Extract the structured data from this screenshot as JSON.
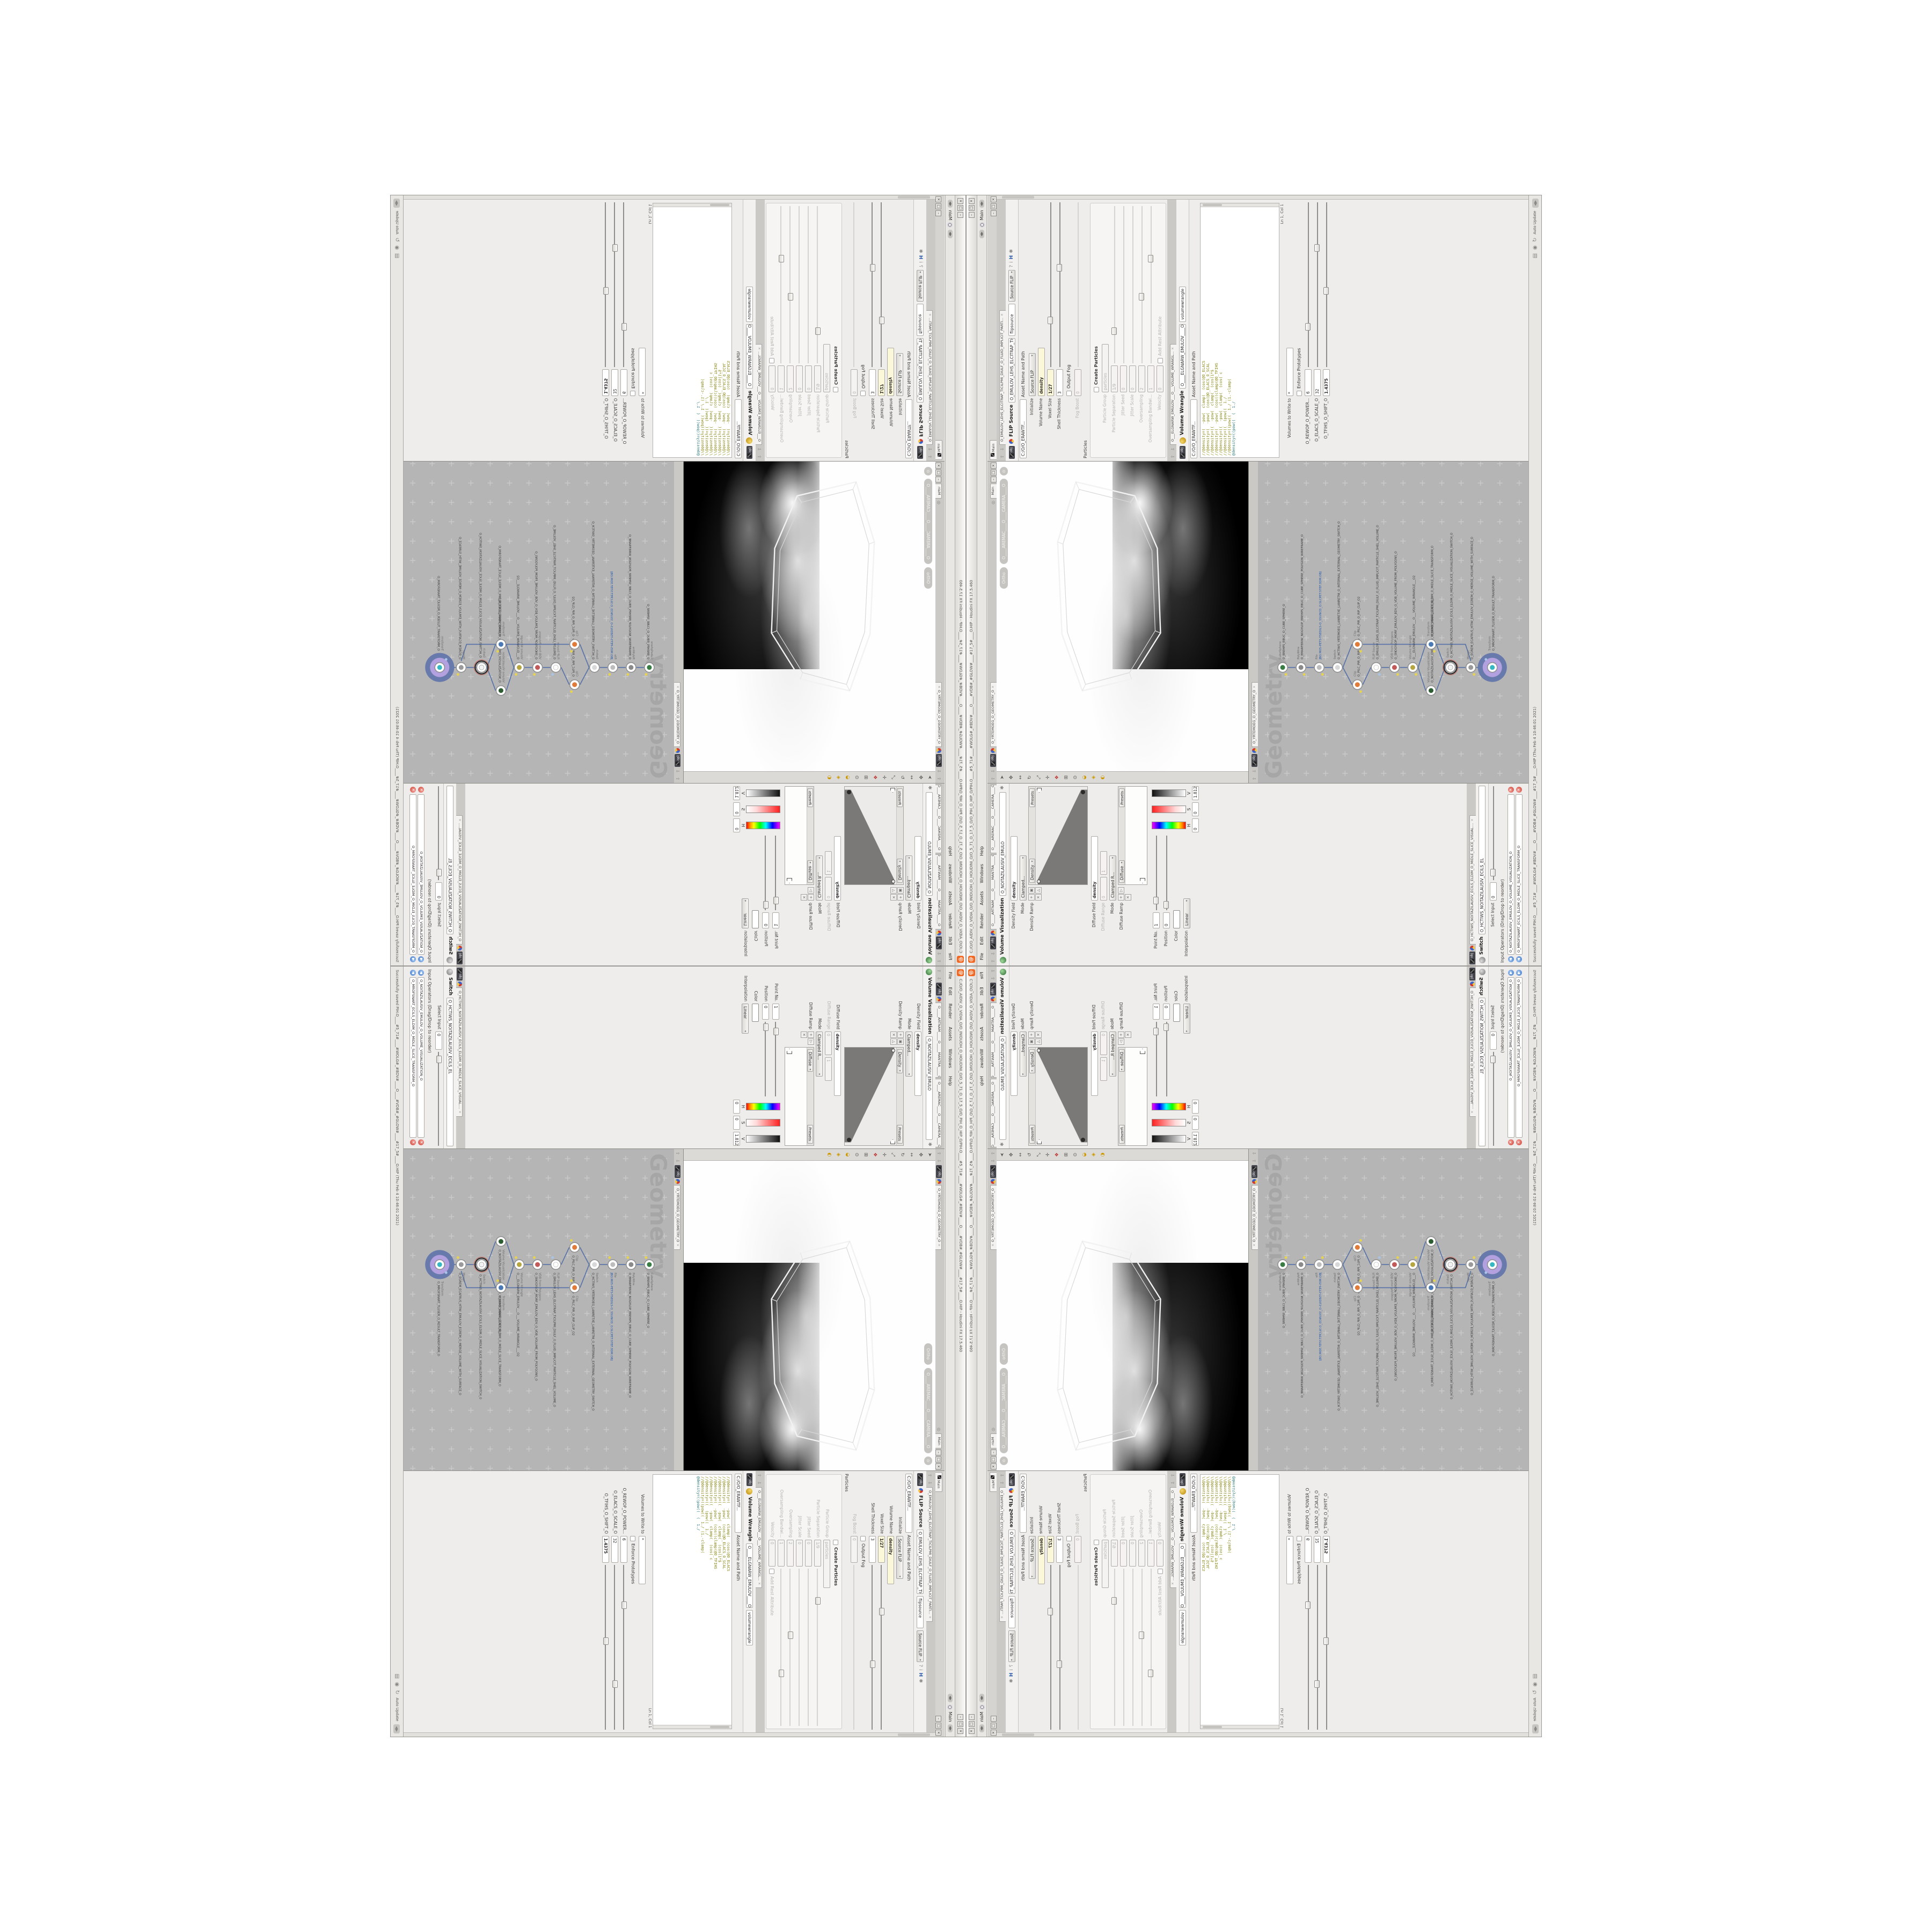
{
  "app": {
    "logo_color": "#f26722",
    "title": "C:/O/O_AIDIV_O_VIDIA_O/O_INIDUOH_O_HOUDINI_O/O_5_71_O_17_5_O/O_PIH_O_HIP_O/PIH.O____#5_71#____#WOLG#_#BDV#____O____#VDB#_#GLOW#____#17_5#____O.HIP - Houdini FX 17.5.460",
    "menus": [
      "File",
      "Edit",
      "Render",
      "Assets",
      "Windows",
      "Help"
    ],
    "desktop_label": "Main",
    "btn_min": "–",
    "btn_max": "□",
    "btn_close": "×"
  },
  "panelbar": {
    "main_tab": "Main"
  },
  "viz": {
    "tab_mantra": "O_____ARTNAM_____O_____MANTRA_____O",
    "tab_camera": "O____AREMAC____O____CAMERA____O",
    "title": "Volume Visualization",
    "name_field": "O_NOITAZILAUSIV_EMULO",
    "density_field_label": "Density Field",
    "density_field_value": "density",
    "mode_label": "Mode",
    "mode_value": "Clamped...",
    "density_ramp_label": "Density Ramp",
    "ramp_selector": "Density",
    "presets_label": "Presets",
    "diffuse_field_label": "Diffuse Field",
    "diffuse_field_value": "density",
    "diffuse_range_label": "Diffuse Range",
    "diffuse_range_v1": "0",
    "diffuse_range_v2": "1",
    "mode2_label": "Mode",
    "mode2_value": "Clamped R...",
    "diffuse_ramp_label": "Diffuse Ramp",
    "ramp_selector2": "Diffuse",
    "point_label": "Point No.",
    "point_value": "1",
    "position_label": "Position",
    "position_value": "0",
    "color_label": "Color",
    "interp_label": "Interpolation",
    "interp_value": "Linear",
    "h_label": "H",
    "h_value": "0",
    "s_label": "S",
    "s_value": "0",
    "v_label": "V",
    "v_value": "1.8125"
  },
  "switch_pane": {
    "tab": "O_HCTIWS_NOITAZILAUSIV_ECILS_ELDIM_O_MIDLE_SLICE_VISUAL....",
    "title": "Switch",
    "name_field": "O_HCTIWS_NOITAZILAUSIV_ECILS_EL",
    "select_label": "Select Input",
    "select_value": "0",
    "ops_label": "Input Operators (Drag/Drop to reorder)",
    "op1": "O_NOITAZILAUSIV_EMULOV_O_VOLUME_VISUALIZATION_O",
    "op2": "O_MROFSNART_ECILS_ELDIM_O_MIDLE_SLICE_TRANSFORM_O"
  },
  "viewport": {
    "tab": "O_YRTEMOEG_O_GEOMETRY_O",
    "ortho_label": "Ortho",
    "camera_pill": "O____AREMAC____O____CAMERA____O"
  },
  "network": {
    "tab": "O_YRTEMOEG_O_GEOMETRY_O",
    "watermark": "Geometry",
    "wire_color": "#5570a8",
    "bg_color": "#b5b5b5",
    "badge_outer": "#6879ab",
    "badge_inner": "#b2a0df",
    "flag_color": "#e8d44d",
    "nodes": [
      {
        "t": "CubeSphere",
        "n": "O_EREHPS_EBUC_O_CUBE_SPHERE_O",
        "c": "#3a7d44"
      },
      {
        "t": "PolyWire",
        "n": "O_EMARFERIW_NOGYLOP_EREHPS_EBUC_O_CUBE_SPHERE_POLYGON_WIREFRAME_O",
        "c": "#8a8a8a"
      },
      {
        "t": "File",
        "n": "JBO.M05-PETS-TSEDILS-O_SSUNCD_O.SLCPET.STEF.3DM.OBJ",
        "c": "#bdbdbd"
      },
      {
        "t": "Switch",
        "n": "O_HCTIWS_YRTEMOEG_LANRETXE_LANRETNI_O_INTERNAL_EXTERNAL_GEOMETRY_SWITCH_O",
        "c": "#d8d8d8"
      },
      {
        "t": "Clip",
        "n": "O_PILC_PIR_O_RIP_CLIP_O",
        "c": "#e07b39"
      },
      {
        "t": "Clip",
        "n": "O_PILC_PIR_O_RIP_CLIP_O2",
        "c": "#e07b39"
      },
      {
        "t": "FLIP Source",
        "n": "O_EMULOV_LEHS_ELCITRAP_TICILPMI_DIULF_O_FLUID_IMPLICIT_PARTICLE_SHEL_VOLUME_O",
        "c": "#ffffff"
      },
      {
        "t": "VDB from Polygons",
        "n": "O_SNOGYLOP_MORF_EMULOV_BDV_O_VDB_VOLUME_FROM_POLYGONS_O",
        "c": "#c25a5a"
      },
      {
        "t": "Volume Wrangle",
        "n": "O___ELGNARW_EMULOV___O___VOLUME_WRANGLE___O2",
        "c": "#b5a642"
      },
      {
        "t": "Volume Visualization",
        "n": "O_NOITAZILAUSIV_EMULOV_O_VOLUME_VISUALIZATION_O",
        "c": "#2e5d34"
      },
      {
        "t": "Transform",
        "n": "O_MROFSNART_ECILS_ELDIM_O_MIDLE_SLICE_TRANSFORM_O",
        "c": "#4a7ab5"
      },
      {
        "t": "Switch",
        "n": "O_HCTIWS_NOITAZILAUSIV_ECILS_ELDIM_O_MIDLE_SLICE_VISUALIZATION_SWITCH_O",
        "c": "#f2f2f2"
      },
      {
        "t": "Merge",
        "n": "O_EGREM_ECAFRUS_HTIW_EMULOV_EGREM_O_MERGE_VOLUME_WITH_SURFACE_O",
        "c": "#9a9a9a"
      },
      {
        "t": "Transform",
        "n": "O_MROFSNART_TLUSER_O_RESULT_TRANSFORM_O",
        "c": "#35b8c4"
      }
    ]
  },
  "flip": {
    "tab": "O_EMULOV_LEHS_ELCITRAP_TICILPMI_DIULF_O_FLUID_IMPLICIT_PARTI...",
    "title": "FLIP Source",
    "name_field": "O_EMULOV_LEHS_ELCITRAP_TICI",
    "inst_field": "flipsource",
    "preset": "Source FLIP",
    "path": "C:/O/O_ERAWTF...",
    "asset_label": "Asset Name and Path",
    "initialize_label": "Initialize",
    "initialize_value": "Source FLIP",
    "volume_name_label": "Volume Name",
    "volume_name_value": "density",
    "voxel_label": "Voxel Size",
    "voxel_value": "1/27",
    "shell_label": "Shell Thickness",
    "shell_value": "3",
    "output_fog_label": "Output Fog",
    "fog_boost_label": "Fog Boost",
    "fog_boost_value": "0",
    "particles_label": "Particles",
    "create_label": "Create Particles",
    "group_label": "Particle Group",
    "group_value": "particles",
    "sep_label": "Particle Separation",
    "sep_value": "1/9",
    "jseed_label": "Jitter Seed",
    "jseed_value": "0",
    "jscale_label": "Jitter Scale",
    "jscale_value": "0",
    "oversampling_label": "Oversampling",
    "oversampling_value": "2",
    "obandw_label": "Oversampling Bandwi...",
    "obandw_value": "1",
    "velocity_label": "Velocity",
    "velocity_value": "0",
    "addrest_label": "Add Rest Attribute"
  },
  "wrangle": {
    "tab": "O___ELGNARW_EMULOV___O___VOLUME_WRANGL...",
    "title": "Volume Wrangle",
    "name_field": "O____ELGNARW_EMULOV____O",
    "inst_field": "volumewrangle",
    "path": "C:/O/O_ERAWTF...",
    "asset_label": "Asset Name and Path",
    "code_lines": [
      "//@density=(  -pow(  clamp(  (cos(@O_ELACS",
      "//@density=(  -pow(  (cos(@O_ELACS_O_SCAL",
      "//@density=((  -pow(  clamp(  (cos(1*$",
      "//@density=(  -pow(  (cos((clamp(@O_TFIHS",
      "//@density=((  -pow(  clamp(  (cos( c",
      "//@density=((  (pow((  1./",
      "//@density=((pow((  1./ (1.-clamp(",
      "@density=((pow((  (  1./"
    ],
    "cursor": "Ln 1, Col 1",
    "volumes_label": "Volumes to Write to",
    "volumes_value": "*",
    "enforce_label": "Enforce Prototypes",
    "p1_label": "O_REWOP_O_POWER...",
    "p1_value": "6",
    "p2_label": "O_ELACS_O_SCALE_O",
    "p2_value": "32",
    "p3_label": "O_TFIHS_O_SHIFT_O",
    "p3_value": "1.4375"
  },
  "statusbar": {
    "message": "Successfully saved PIH.O____#5_71#____#WOLG#_#BDV#____O____#VDB#_#GLOW#____#17_5#____O.HIP (Thu Feb 4 10:46:01 2021)",
    "auto_update_label": "Auto Update"
  }
}
